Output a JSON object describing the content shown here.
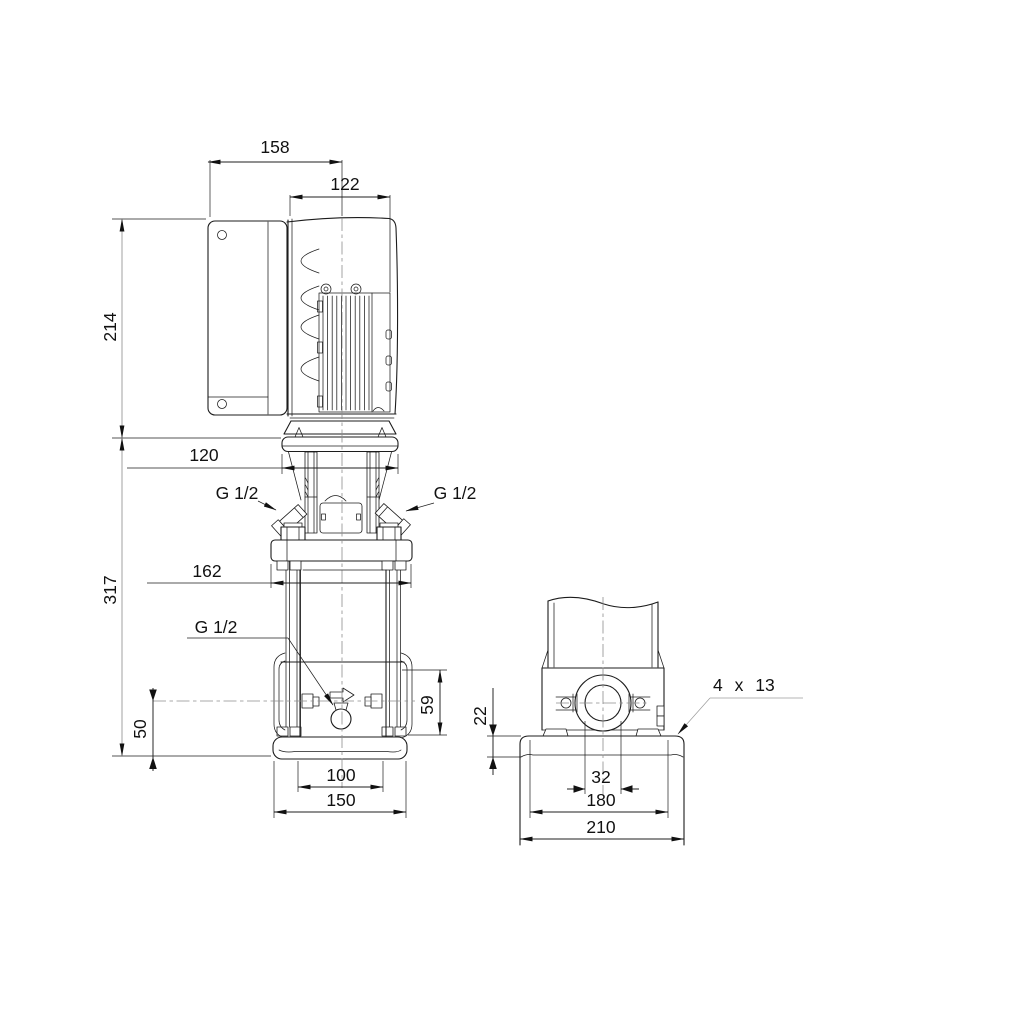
{
  "drawing": {
    "background": "#ffffff",
    "line_color": "#1c1c1c",
    "leader_color": "#9c9c9c",
    "text_color": "#111111",
    "dims": {
      "w158": "158",
      "w122": "122",
      "h214": "214",
      "w120": "120",
      "h317": "317",
      "w162": "162",
      "h50": "50",
      "h59": "59",
      "w100": "100",
      "w150": "150",
      "h22": "22",
      "w32": "32",
      "w180": "180",
      "w210": "210",
      "port_top_left": "G 1/2",
      "port_top_right": "G 1/2",
      "port_drain": "G 1/2",
      "base_holes": "4 x 13"
    }
  }
}
